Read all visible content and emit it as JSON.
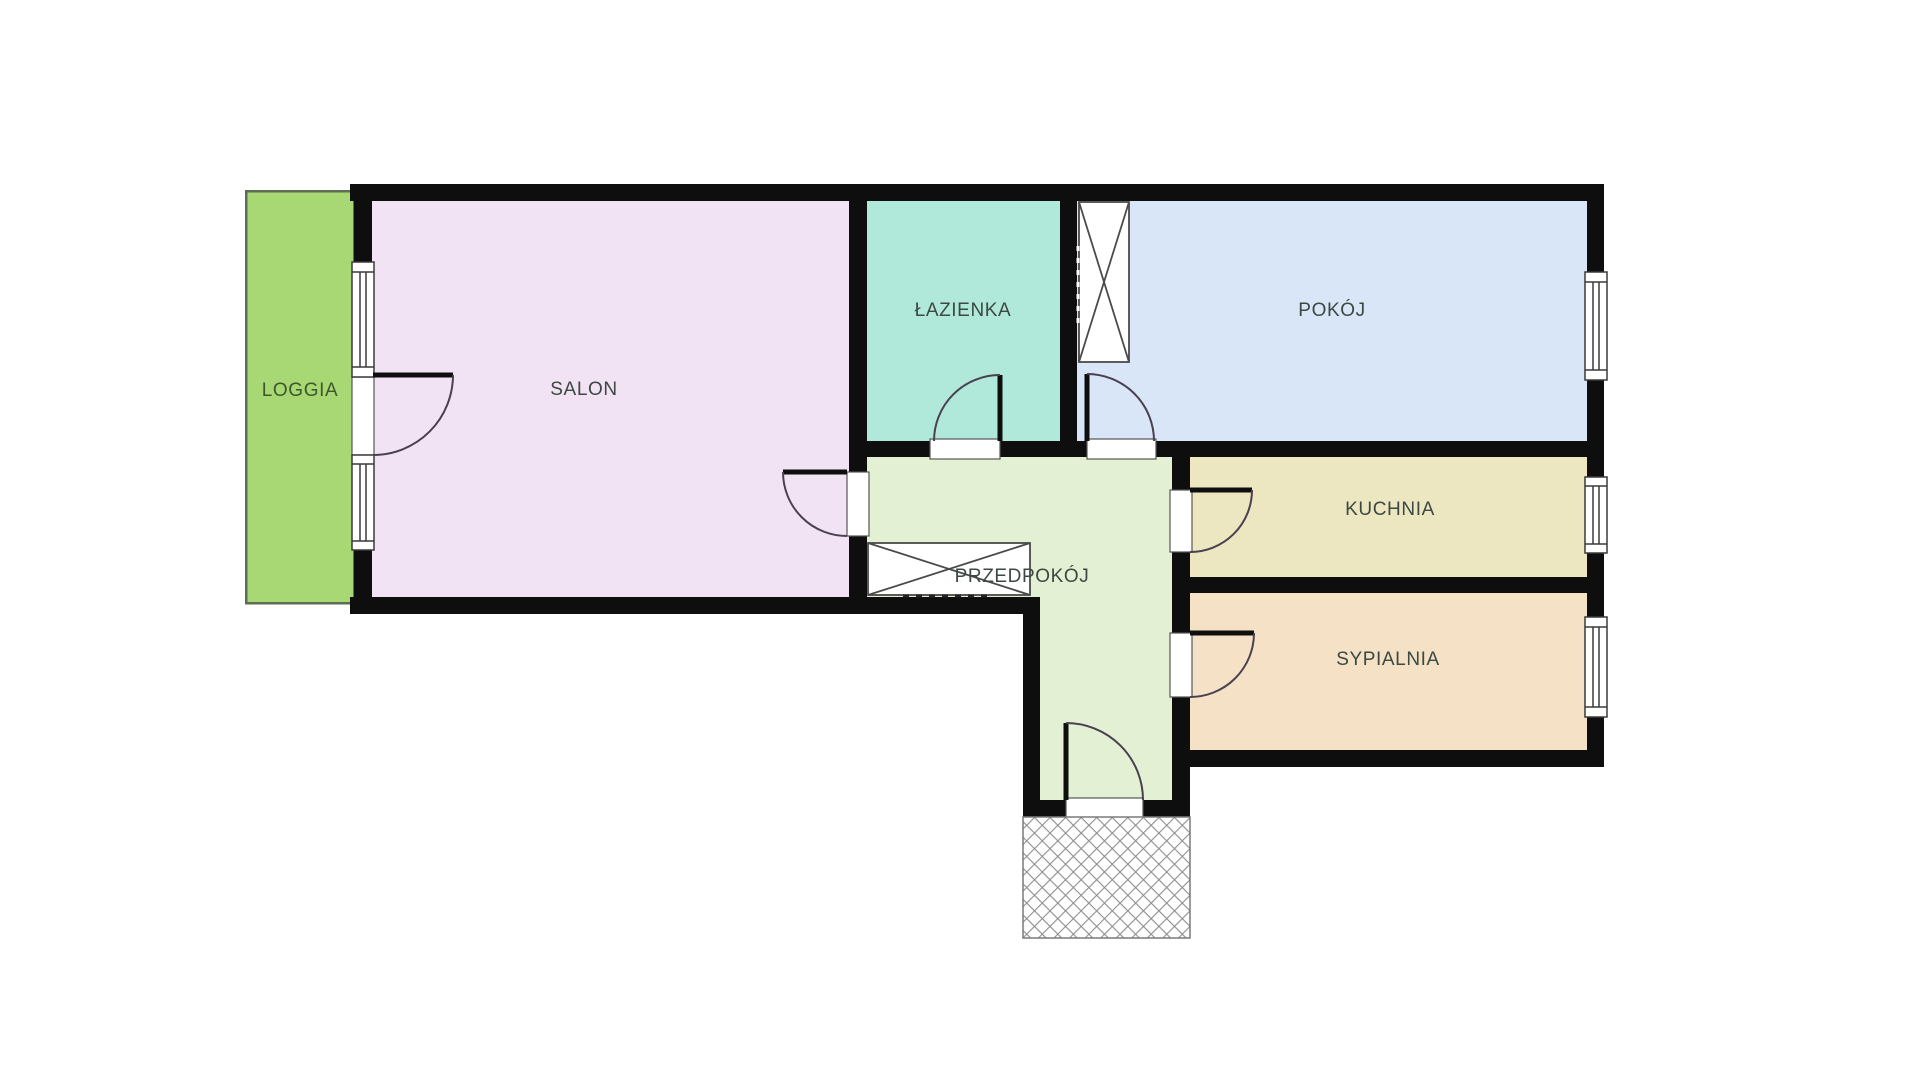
{
  "floorplan": {
    "background": "#ffffff",
    "wall_color": "#0e0e0e",
    "door_color": "#4a4150",
    "window_frame_color": "#3a3a3a",
    "sill_frame_color": "#555555",
    "fixture_line_color": "#4a4a4a",
    "hatch_line_color": "#8f8f8f",
    "hatch_border_color": "#7a7a7a",
    "label_color": "#3d4842",
    "loggia_border_color": "#5f6e52",
    "rooms": [
      {
        "id": "loggia",
        "label": "LOGGIA",
        "color": "#a8d873",
        "label_color": "#41562c"
      },
      {
        "id": "salon",
        "label": "SALON",
        "color": "#f2e3f4"
      },
      {
        "id": "lazienka",
        "label": "ŁAZIENKA",
        "color": "#b0e9da"
      },
      {
        "id": "pokoj",
        "label": "POKÓJ",
        "color": "#d8e6f7"
      },
      {
        "id": "przedpokoj",
        "label": "PRZEDPOKÓJ",
        "color": "#e3f0d4"
      },
      {
        "id": "kuchnia",
        "label": "KUCHNIA",
        "color": "#ece7c0"
      },
      {
        "id": "sypialnia",
        "label": "SYPIALNIA",
        "color": "#f4e1c6"
      }
    ]
  }
}
